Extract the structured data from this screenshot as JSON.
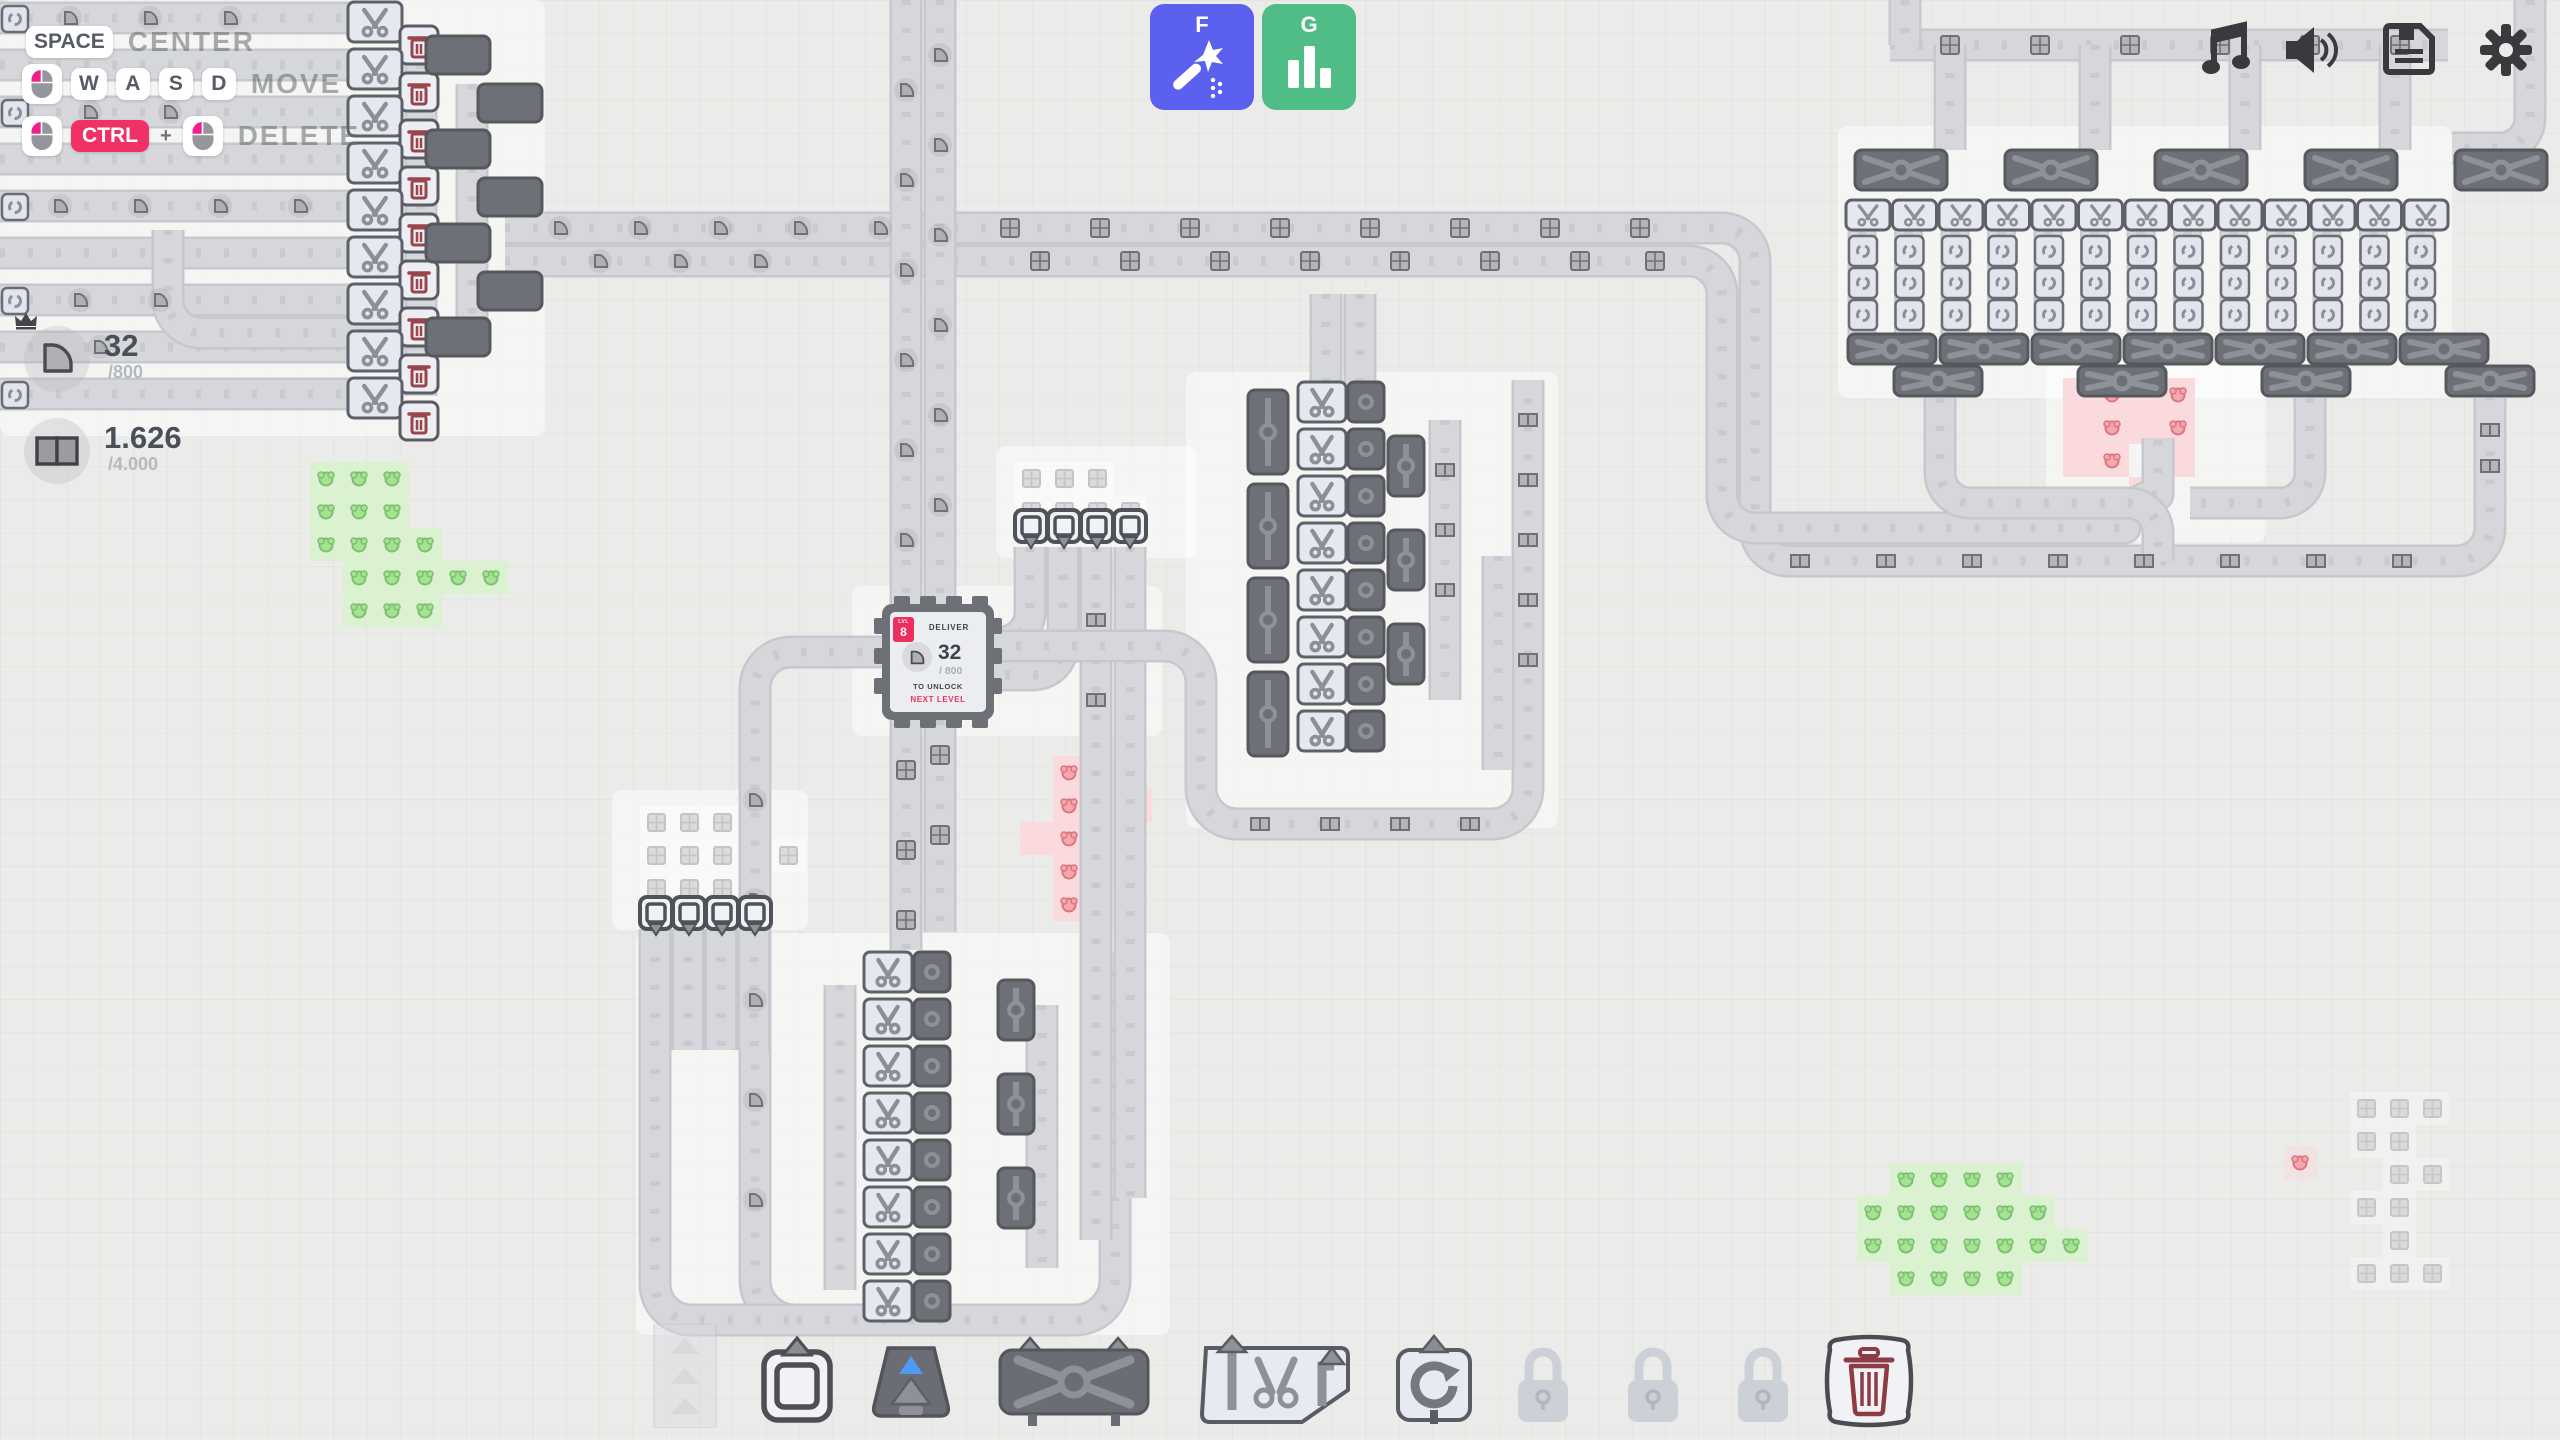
{
  "hints": {
    "space_key": "SPACE",
    "center_label": "CENTER",
    "key_w": "W",
    "key_a": "A",
    "key_s": "S",
    "key_d": "D",
    "move_label": "MOVE",
    "ctrl_key": "CTRL",
    "plus": "+",
    "delete_label": "DELETE"
  },
  "pins": {
    "pin1": {
      "shape": "quarter-pie",
      "value": "32",
      "goal": "/800",
      "has_crown": true
    },
    "pin2": {
      "shape": "half-rect-two-squares",
      "value": "1.626",
      "goal": "/4.000",
      "has_crown": false
    }
  },
  "quick_buttons": {
    "f_key": "F",
    "f_icon": "magic-wand-icon",
    "f_color": "#5b61ee",
    "g_key": "G",
    "g_icon": "bar-chart-icon",
    "g_color": "#4fbd85"
  },
  "top_right_icons": [
    "music-icon",
    "speaker-icon",
    "save-icon",
    "settings-gear-icon"
  ],
  "hub": {
    "level_label": "LVL",
    "level": "8",
    "deliver_label": "DELIVER",
    "shape": "quarter-pie",
    "value": "32",
    "goal": "/ 800",
    "unlock_line1": "TO UNLOCK",
    "unlock_line2": "NEXT LEVEL"
  },
  "toolbar": {
    "slots": [
      {
        "name": "belt",
        "state": "dimmed"
      },
      {
        "name": "extractor",
        "state": "available"
      },
      {
        "name": "underground-belt",
        "state": "available"
      },
      {
        "name": "balancer",
        "state": "available"
      },
      {
        "name": "cutter",
        "state": "available"
      },
      {
        "name": "rotator",
        "state": "available"
      },
      {
        "name": "locked-slot-1",
        "state": "locked"
      },
      {
        "name": "locked-slot-2",
        "state": "locked"
      },
      {
        "name": "locked-slot-3",
        "state": "locked"
      },
      {
        "name": "trash",
        "state": "available"
      }
    ]
  },
  "colors": {
    "accent_pink": "#ef2e60",
    "button_blue": "#5b61ee",
    "button_green": "#4fbd85",
    "belt_gray": "#d6d7db",
    "machine_dark": "#6e7077",
    "machine_light": "#e6e8f0",
    "resource_green": "#daf2cf",
    "resource_red": "#fadadd"
  }
}
